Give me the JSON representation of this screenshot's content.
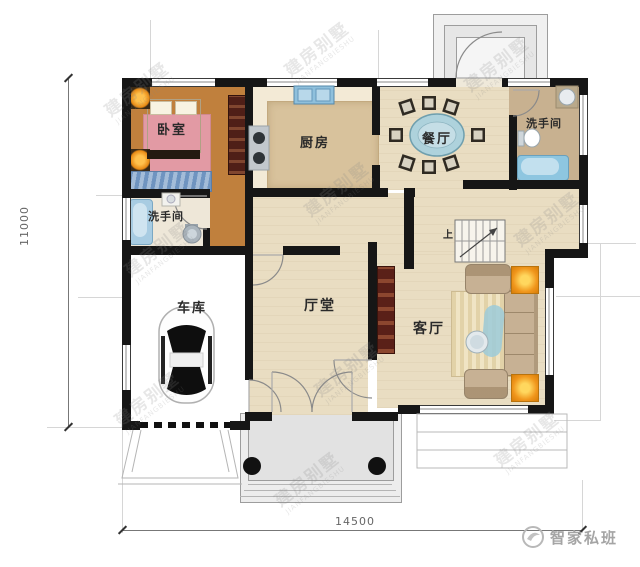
{
  "plan": {
    "title_hint": "residential floor plan",
    "rooms": {
      "bedroom": {
        "label": "卧室"
      },
      "kitchen": {
        "label": "厨房"
      },
      "dining": {
        "label": "餐厅"
      },
      "bath_upper_right": {
        "label": "洗手间"
      },
      "bath_left": {
        "label": "洗手间"
      },
      "garage": {
        "label": "车库"
      },
      "hall": {
        "label": "厅堂"
      },
      "living": {
        "label": "客厅"
      }
    },
    "stairs": {
      "up_label": "上"
    },
    "dimensions": {
      "height_mm": "11000",
      "width_mm": "14500"
    },
    "watermark": {
      "line1": "建房别墅",
      "line2": "JIANFANGBIESHU"
    },
    "logo": {
      "text": "智家私班"
    },
    "icons": {
      "car": "top-view car in garage",
      "bed": "double bed with pillows",
      "wardrobe": "wardrobe cabinet",
      "bathtub": "bathtub",
      "toilet": "toilet",
      "sink": "wash basin",
      "stove": "two-burner stove",
      "dining-table": "oval table with 8 chairs",
      "sofa": "sofa set with coffee table",
      "tv-cabinet": "TV cabinet",
      "stairs": "staircase going up"
    },
    "colors": {
      "wall": "#161616",
      "bedroom_floor": "#c0803d",
      "kitchen_floor": "#f3ead6",
      "hall_floor": "#e9ddc2",
      "bath_right_floor": "#c8b190",
      "garage_floor": "#f2e5c9",
      "counter": "#d8c29c",
      "table_blue": "#aed2dc",
      "lamp_orange": "#f0961c",
      "sofa_tan": "#c7b194",
      "cabinet_maroon": "#5a2018",
      "tub_blue": "#a8cce2"
    }
  }
}
